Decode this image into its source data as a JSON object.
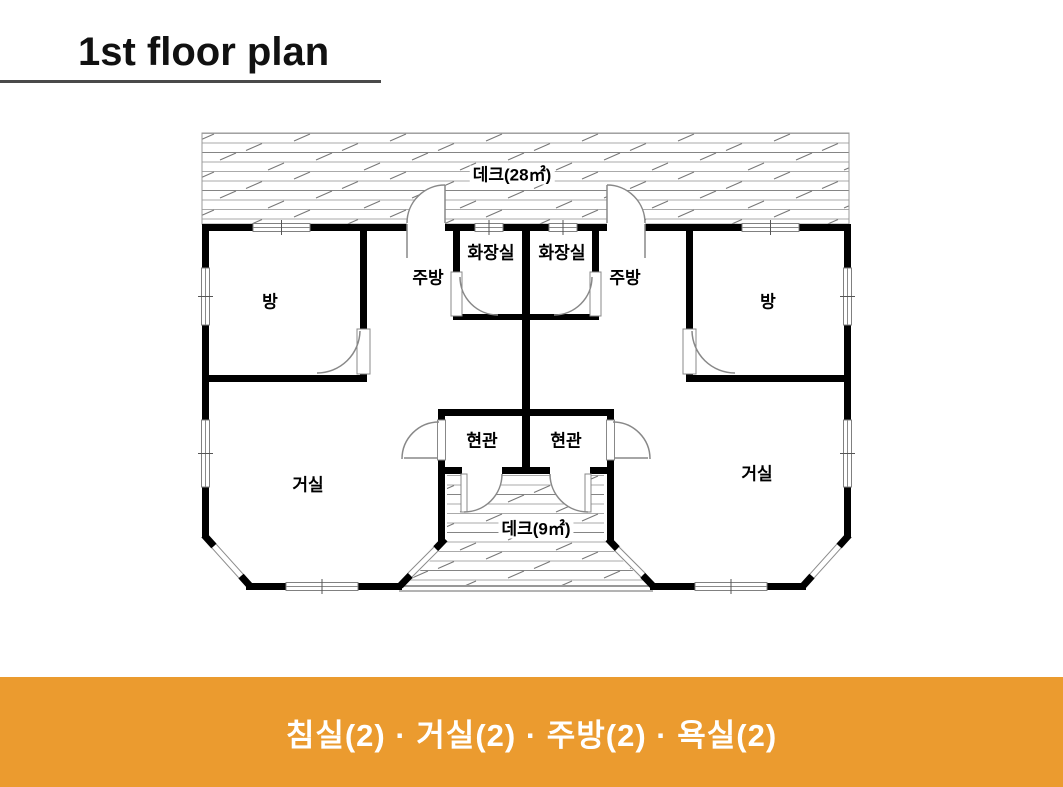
{
  "title": "1st floor plan",
  "floor_plan": {
    "deck_top_label": "데크(28㎡)",
    "deck_bottom_label": "데크(9㎡)",
    "bathroom_label": "화장실",
    "kitchen_label": "주방",
    "bedroom_label": "방",
    "entrance_label": "현관",
    "living_room_label": "거실"
  },
  "banner": {
    "text": "침실(2) · 거실(2) · 주방(2) · 욕실(2)",
    "bg_color": "#EB9B2F",
    "text_color": "#FFFFFF"
  },
  "colors": {
    "wall": "#000000",
    "thin_line": "#888888",
    "underline": "#4A4A4A"
  }
}
